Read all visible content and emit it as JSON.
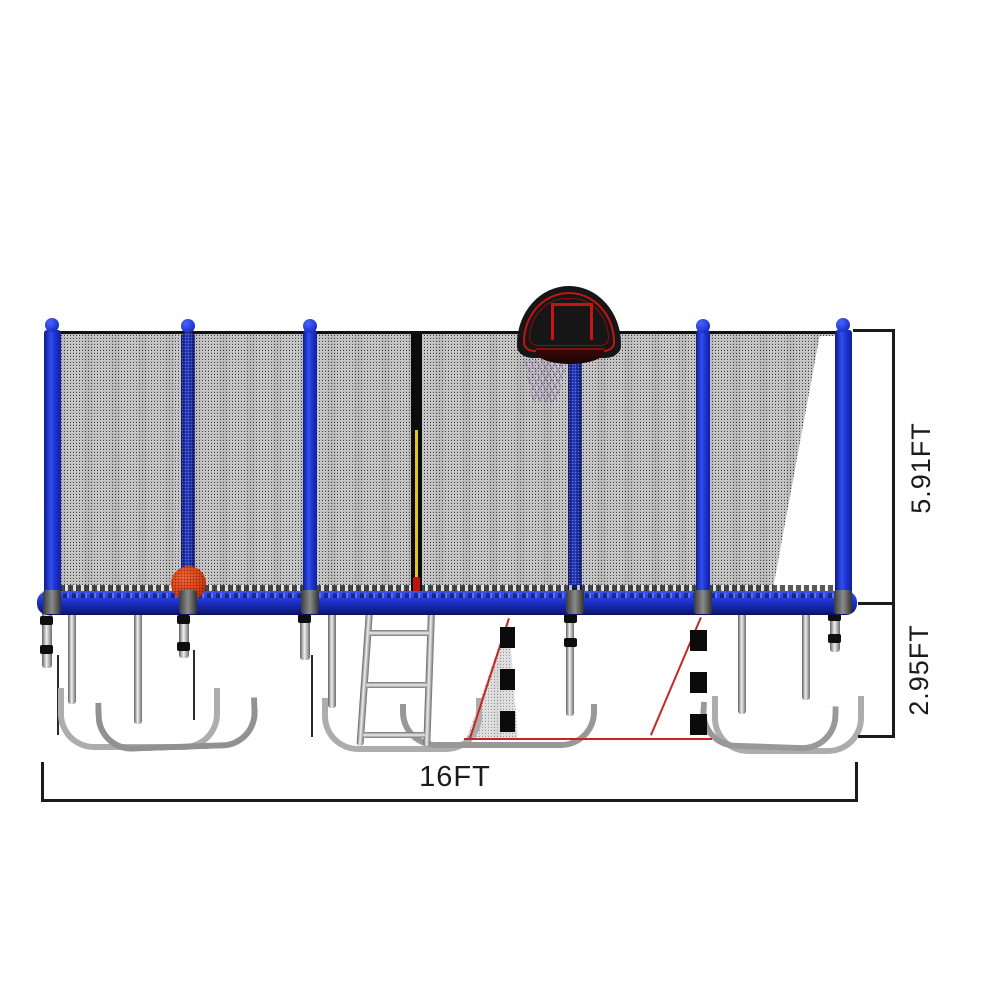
{
  "page": {
    "type": "product-dimension-diagram",
    "background": "#ffffff",
    "subject": "16FT trampoline with safety enclosure net, basketball hoop and ladder"
  },
  "annotations": {
    "net_height_label": "5.91FT",
    "frame_height_label": "2.95FT",
    "width_label": "16FT"
  },
  "palette": {
    "pole_blue": "#2038d8",
    "pole_blue_dark": "#13217f",
    "frame_rail_blue": "#1e33d4",
    "net_dot": "#191919",
    "steel_light": "#f0f0f0",
    "steel_dark": "#5f5f5f",
    "backboard_black": "#161616",
    "hoop_outline_red": "#c41414",
    "rim_dark_red": "#3a0808",
    "basketball_orange": "#d8430f",
    "zipper_black": "#0c0c0c",
    "zipper_string_yellow": "#e2c51c",
    "zipper_pull_red": "#c41111",
    "hidden_marker_black": "#0b0b0b",
    "guide_line_red": "#c22727",
    "dimension_line_black": "#1b1b1b"
  }
}
